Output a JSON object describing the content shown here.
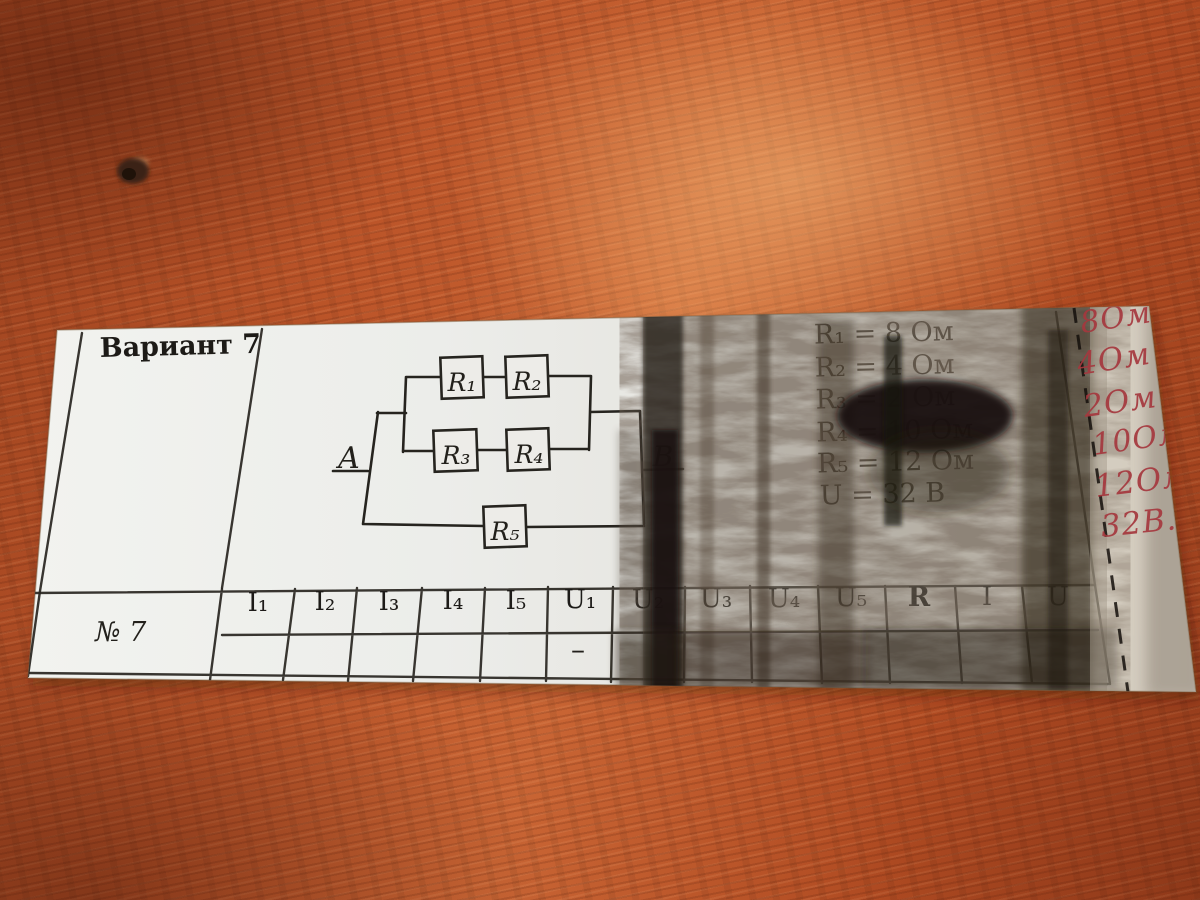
{
  "surface": {
    "wood_color": "#b14e26"
  },
  "paper": {
    "paper_color": "#ecedea",
    "variant_label": "Вариант 7",
    "circuit": {
      "node_a": "A",
      "node_b": "B",
      "resistors": [
        "R₁",
        "R₂",
        "R₃",
        "R₄",
        "R₅"
      ]
    },
    "given_values": [
      "R₁ = 8 Ом",
      "R₂ = 4 Ом",
      "R₃ = 2 Ом",
      "R₄ = 10 Ом",
      "R₅ = 12 Ом",
      "U = 32 В"
    ],
    "handwritten_notes": [
      "8Ом",
      "4Ом",
      "2Ом",
      "10Ом",
      "12Ом",
      "32В."
    ],
    "handwriting_color": "#a5383e",
    "table": {
      "row_label": "№ 7",
      "columns": [
        "I₁",
        "I₂",
        "I₃",
        "I₄",
        "I₅",
        "U₁",
        "U₂",
        "U₃",
        "U₄",
        "U₅",
        "R",
        "I",
        "U"
      ],
      "row_values": [
        "",
        "",
        "",
        "",
        "",
        "–",
        "",
        "",
        "",
        "",
        "",
        "",
        ""
      ]
    }
  }
}
